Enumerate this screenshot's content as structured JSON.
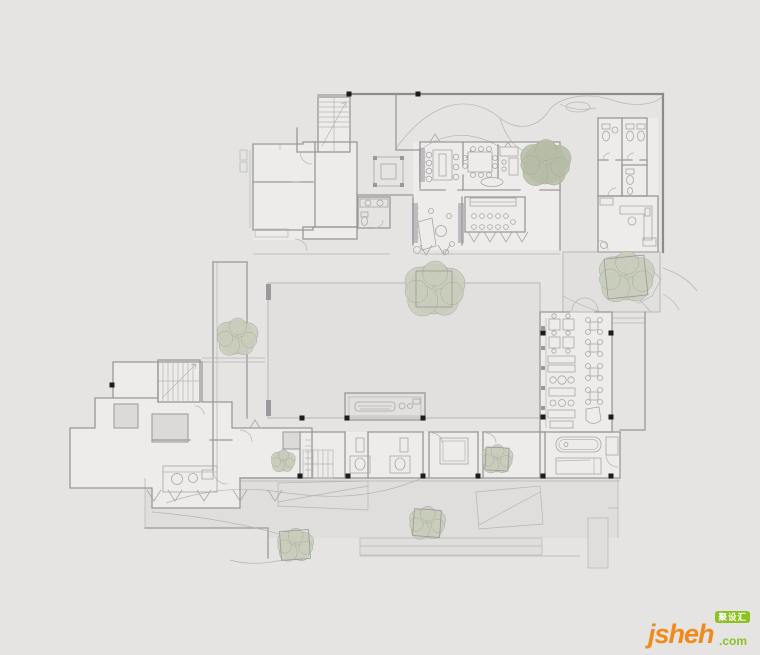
{
  "watermark": {
    "brand": "jsheh",
    "tld": ".com",
    "badge": "聚设汇"
  },
  "palette": {
    "background": "#e5e4e2",
    "wall": "#99989a",
    "wall_dark": "#8b8a8c",
    "line_light": "#b6b5b3",
    "furniture": "#a7a6a4",
    "room": "#edecea",
    "court": "#e1e0de",
    "walk": "#dfdedc",
    "gray_room": "#dbdad8",
    "column": "#1c1c1c",
    "tree_fill": "#c9ccbc",
    "tree_dark": "#b6bca7",
    "tree_edge": "#a6ab98",
    "logo_orange": "#f18a1c",
    "logo_green": "#8cc122",
    "badge_text": "#ffffff"
  },
  "plan": {
    "trees": [
      {
        "x": 545,
        "y": 163,
        "r": 21,
        "planter": false,
        "dark": true
      },
      {
        "x": 434,
        "y": 289,
        "r": 25,
        "planter": true,
        "pw": 36,
        "rot": 0
      },
      {
        "x": 626,
        "y": 277,
        "r": 23,
        "planter": true,
        "pw": 40,
        "rot": -6
      },
      {
        "x": 237,
        "y": 337,
        "r": 17,
        "planter": false
      },
      {
        "x": 283,
        "y": 461,
        "r": 10,
        "planter": false
      },
      {
        "x": 497,
        "y": 459,
        "r": 13,
        "planter": true,
        "pw": 23,
        "rot": 3
      },
      {
        "x": 295,
        "y": 545,
        "r": 15,
        "planter": true,
        "pw": 29,
        "rot": -4
      },
      {
        "x": 427,
        "y": 523,
        "r": 15,
        "planter": true,
        "pw": 27,
        "rot": 4
      }
    ],
    "columns": [
      [
        349,
        94
      ],
      [
        418,
        94
      ],
      [
        112,
        385
      ],
      [
        302,
        418
      ],
      [
        347,
        418
      ],
      [
        423,
        418
      ],
      [
        543,
        333
      ],
      [
        611,
        333
      ],
      [
        543,
        417
      ],
      [
        611,
        417
      ],
      [
        300,
        476
      ],
      [
        348,
        476
      ],
      [
        423,
        476
      ],
      [
        478,
        476
      ],
      [
        543,
        476
      ],
      [
        611,
        476
      ]
    ]
  }
}
